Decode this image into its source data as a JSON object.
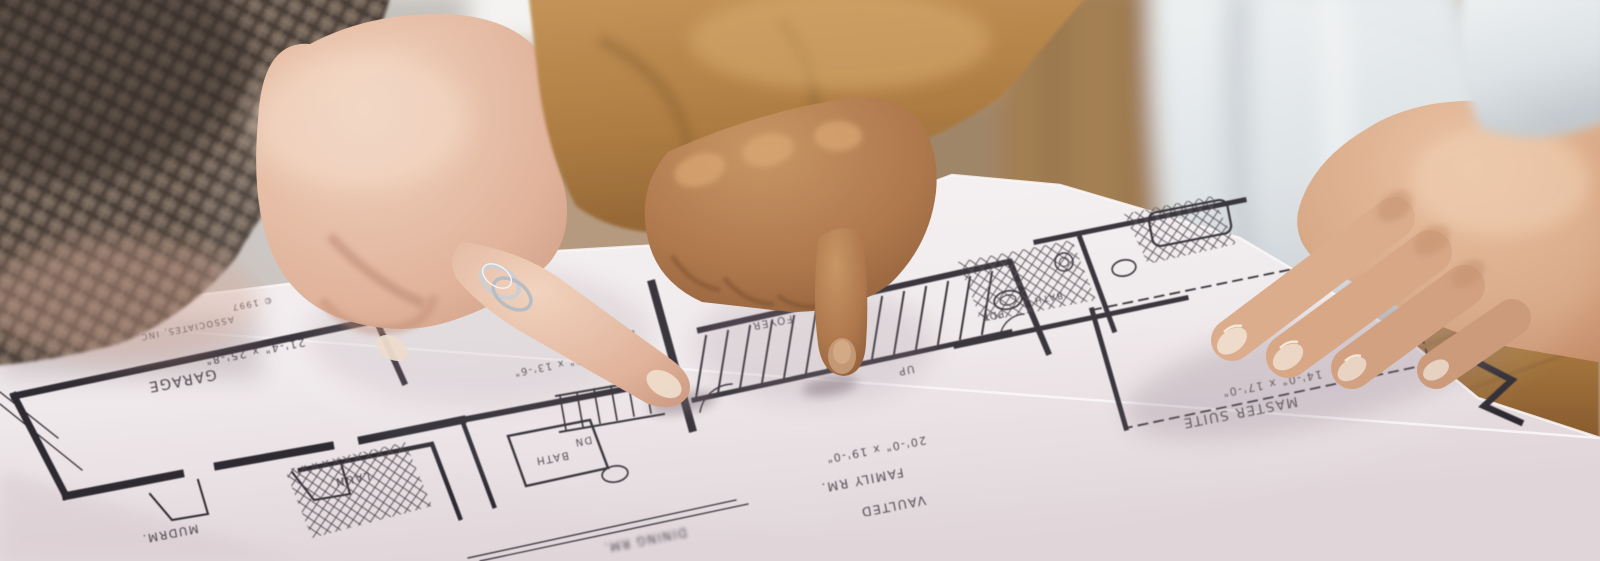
{
  "scene": {
    "description": "Close-up photo: three people at a table; two hands pointing at an upside-down architectural floor-plan blueprint, one hand resting on it",
    "colors": {
      "paper": "#f3eef0",
      "paper_shadow": "#ddd1d6",
      "plan_line": "#2e2a30",
      "plaid_sleeve": "#6e6057",
      "camel_sleeve": "#b07c3f",
      "white_garment": "#e6e9ea",
      "wood_table": "#b08352",
      "skin_left": "#e5bca4",
      "skin_center": "#a96f41",
      "skin_right": "#dcab8a"
    }
  },
  "blueprint": {
    "copyright": {
      "line1": "© 1997",
      "line2": "ASSOCIATES, INC."
    },
    "rooms": {
      "garage": {
        "name": "GARAGE",
        "dims": "21'-4\" x 25'-8\""
      },
      "family": {
        "line1": "VAULTED",
        "line2": "FAMILY RM.",
        "dims": "20'-0\" x 19'-0\""
      },
      "master": {
        "name": "MASTER SUITE",
        "dims": "14'-0\" x 17'-0\""
      },
      "breakfast": {
        "name": "BKFST RM.",
        "dims": "12'-0\" x 13'-6\""
      },
      "dining": {
        "name": "DINING RM."
      },
      "mudroom": {
        "name": "MUDRM."
      },
      "laundry": {
        "name": "LAUN."
      },
      "bath": {
        "name": "BATH"
      },
      "bath2": {
        "name": "BATH"
      },
      "powder": {
        "name": "PDR."
      },
      "foyer": {
        "name": "FOYER"
      }
    },
    "stairs": {
      "up": "UP",
      "down": "DN"
    }
  }
}
